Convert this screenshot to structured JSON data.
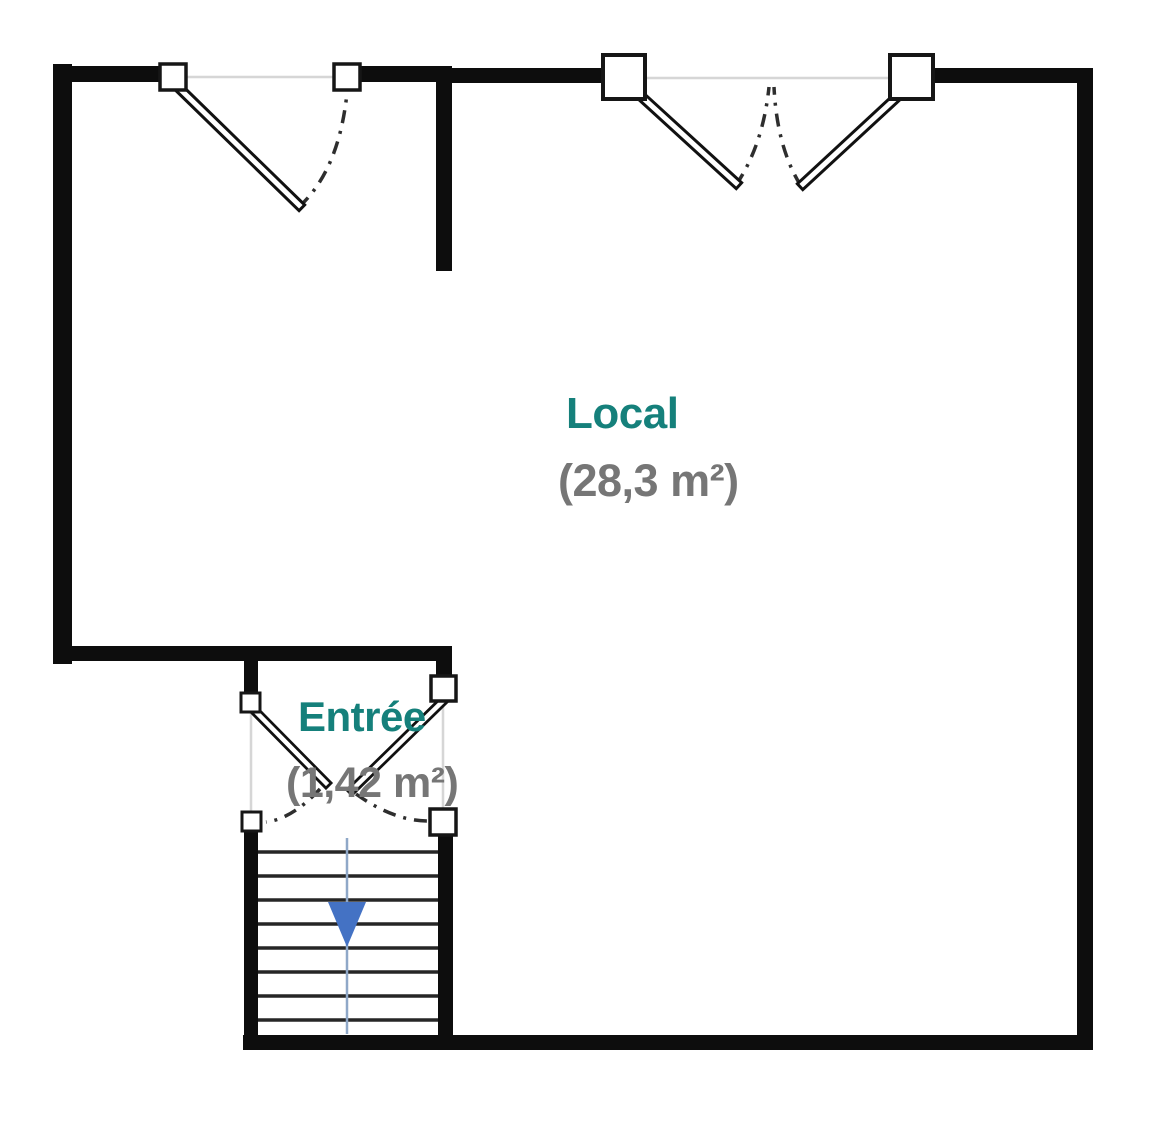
{
  "plan": {
    "type": "floor-plan",
    "rooms": [
      {
        "name": "Local",
        "area": "(28,3 m²)"
      },
      {
        "name": "Entrée",
        "area": "(1,42 m²)"
      }
    ],
    "stairs": {
      "tread_count": 8,
      "direction": "down",
      "arrow_icon": "arrow-down-icon"
    },
    "doors": {
      "single_doors": 1,
      "double_doors": 2
    },
    "colors": {
      "wall": "#0d0d0d",
      "room_name_text": "#15807b",
      "room_area_text": "#767676",
      "stair_arrow": "#4472c4",
      "stair_walkline": "#8fa8c8",
      "opening_guide": "#d6d6d6",
      "swing_arc": "#2e2e2e",
      "background": "#ffffff"
    }
  }
}
